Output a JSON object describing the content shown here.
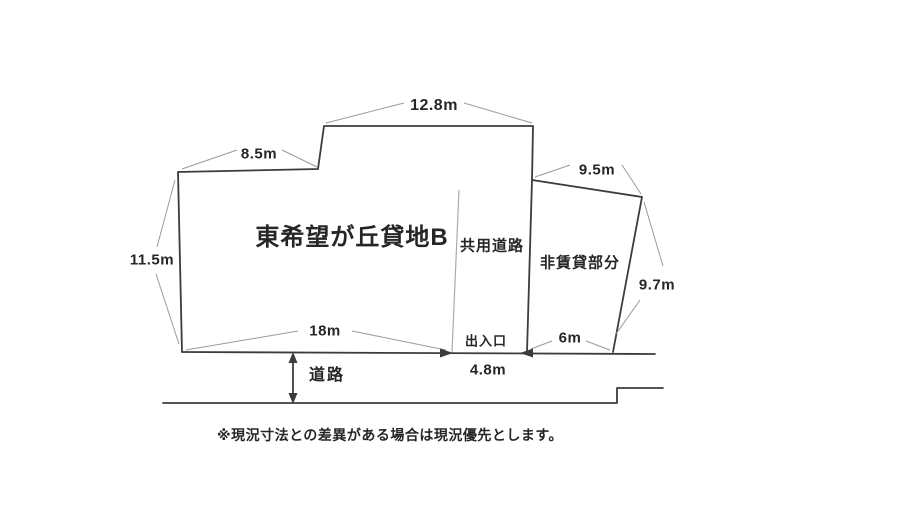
{
  "diagram": {
    "colors": {
      "line": "#3c3c3c",
      "leader": "#9b9b9b",
      "text": "#262626",
      "background": "#ffffff"
    },
    "parcels": {
      "main_label": "東希望が丘貸地B",
      "shared_road_label": "共用道路",
      "non_rental_label": "非賃貸部分"
    },
    "dimensions": {
      "top": "12.8m",
      "top_left": "8.5m",
      "top_right": "9.5m",
      "left": "11.5m",
      "right": "9.7m",
      "bottom_main": "18m",
      "bottom_right": "6m",
      "entrance_width": "4.8m"
    },
    "annotations": {
      "entrance": "出入口",
      "road": "道路"
    },
    "note": "※現況寸法との差異がある場合は現況優先とします。"
  }
}
